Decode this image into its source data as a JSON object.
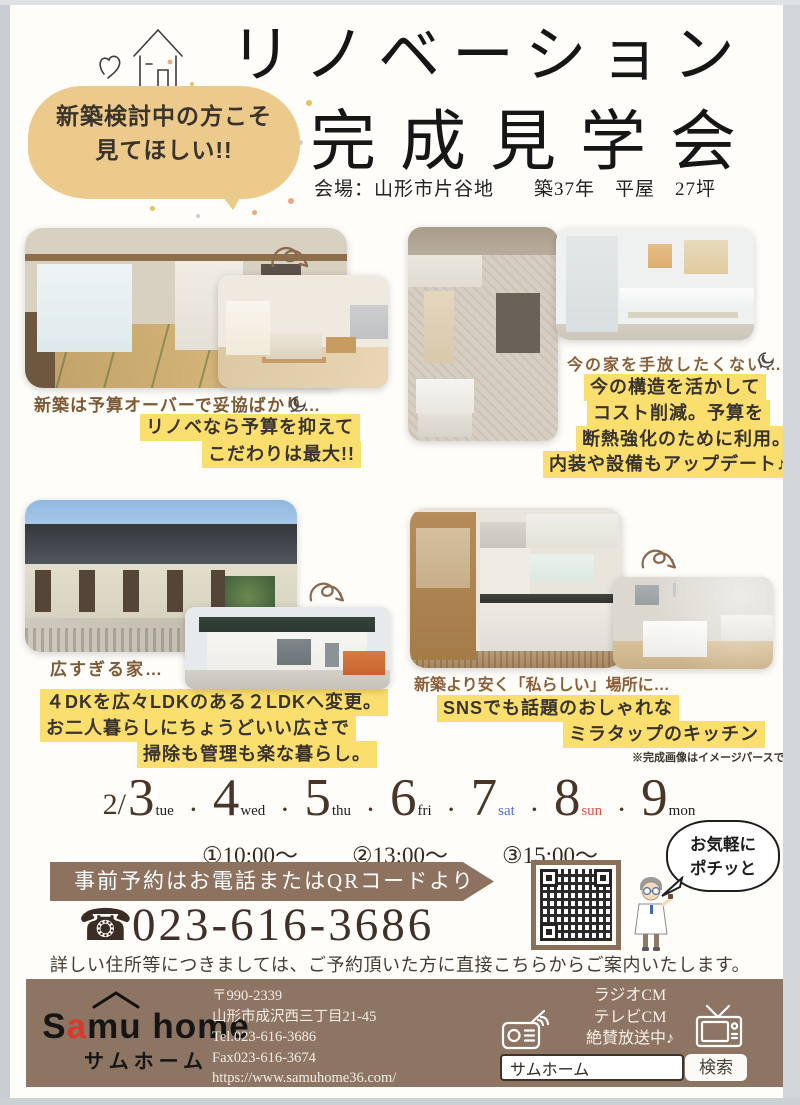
{
  "page": {
    "title_line1": "リノベーション",
    "title_line2": "完成見学会",
    "venue": "会場：山形市片谷地　　築37年　平屋　27坪"
  },
  "intro_bubble": {
    "line1": "新築検討中の方こそ",
    "line2": "見てほしい!!"
  },
  "sections": {
    "budget": {
      "caption": "新築は予算オーバーで妥協ばかり…",
      "hl1": "リノベなら予算を抑えて",
      "hl2": "こだわりは最大!!"
    },
    "keep": {
      "caption": "今の家を手放したくない…",
      "hl1": "今の構造を活かして",
      "hl2": "コスト削減。予算を",
      "hl3": "断熱強化のために利用。",
      "hl4": "内装や設備もアップデート♪"
    },
    "size": {
      "caption": "広すぎる家…",
      "hl1": "４DKを広々LDKのある２LDKへ変更。",
      "hl2": "お二人暮らしにちょうどいい広さで",
      "hl3": "掃除も管理も楽な暮らし。"
    },
    "kitchen": {
      "caption": "新築より安く「私らしい」場所に…",
      "hl1": "SNSでも話題のおしゃれな",
      "hl2": "ミラタップのキッチン",
      "note": "※完成画像はイメージパースです"
    }
  },
  "schedule": {
    "month_prefix": "2/",
    "separator": "・",
    "days": [
      {
        "num": "3",
        "dow": "tue"
      },
      {
        "num": "4",
        "dow": "wed"
      },
      {
        "num": "5",
        "dow": "thu"
      },
      {
        "num": "6",
        "dow": "fri"
      },
      {
        "num": "7",
        "dow": "sat"
      },
      {
        "num": "8",
        "dow": "sun"
      },
      {
        "num": "9",
        "dow": "mon"
      }
    ],
    "times": [
      "①10:00〜",
      "②13:00〜",
      "③15:00〜"
    ]
  },
  "reservation": {
    "banner": "事前予約はお電話またはQRコードより",
    "phone_icon": "☎",
    "phone": "023-616-3686",
    "note": "詳しい住所等につきましては、ご予約頂いた方に直接こちらからご案内いたします。",
    "cta_line1": "お気軽に",
    "cta_line2": "ポチッと"
  },
  "footer": {
    "logo_part1": "S",
    "logo_accent": "a",
    "logo_part2": "mu home",
    "logo_jp": "サムホーム",
    "postal": "〒990-2339",
    "address": "山形市成沢西三丁目21-45",
    "tel": "Tel.023-616-3686",
    "fax": "Fax023-616-3674",
    "url": "https://www.samuhome36.com/",
    "cm1": "ラジオCM",
    "cm2": "テレビCM",
    "cm3": "絶賛放送中♪",
    "search_value": "サムホーム",
    "search_button": "検索"
  },
  "colors": {
    "highlight_yellow": "#fbdf6e",
    "bubble_tan": "#ecca8b",
    "banner_brown": "#8d7260",
    "footer_brown": "#8d7463",
    "date_brown": "#4a3629",
    "sat_blue": "#4d6ee0",
    "sun_red": "#e65048",
    "logo_red": "#d8392b"
  }
}
